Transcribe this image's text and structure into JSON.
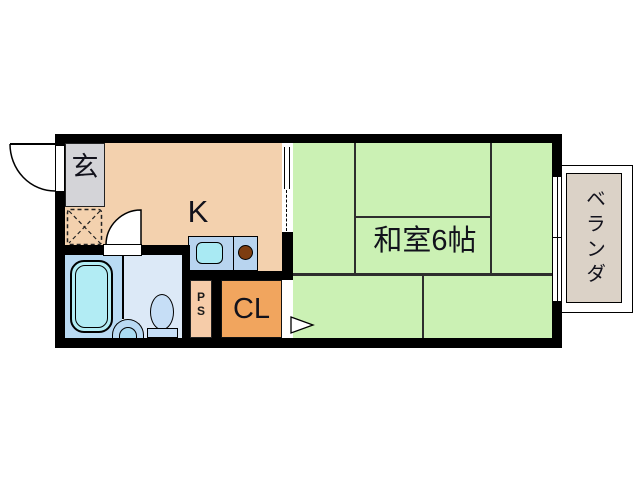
{
  "title": "1K apartment floor plan",
  "rooms": {
    "genkan": {
      "label": "玄"
    },
    "kitchen": {
      "label": "K"
    },
    "washitsu": {
      "label": "和室6帖"
    },
    "closet": {
      "label": "CL"
    },
    "pipe_space": {
      "letters": [
        "P",
        "S"
      ]
    },
    "balcony": {
      "label": "ベランダ"
    }
  },
  "colors": {
    "wall": "#000000",
    "kitchen_floor": "#f3d1ae",
    "washitsu_floor": "#cbf1b4",
    "closet_floor": "#f1a55e",
    "pipe_space_floor": "#f6cca9",
    "genkan_floor": "#d4d4d8",
    "balcony_floor": "#dbd2c7",
    "bath_floor": "#b9daf3",
    "toilet_floor": "#dce9f7",
    "bathtub": "#b2ecf4",
    "toilet_fixture": "#c6def6",
    "sink_counter": "#b8d4ef",
    "sink_basin": "#a9eaf3",
    "burner": "#7d3d10"
  }
}
